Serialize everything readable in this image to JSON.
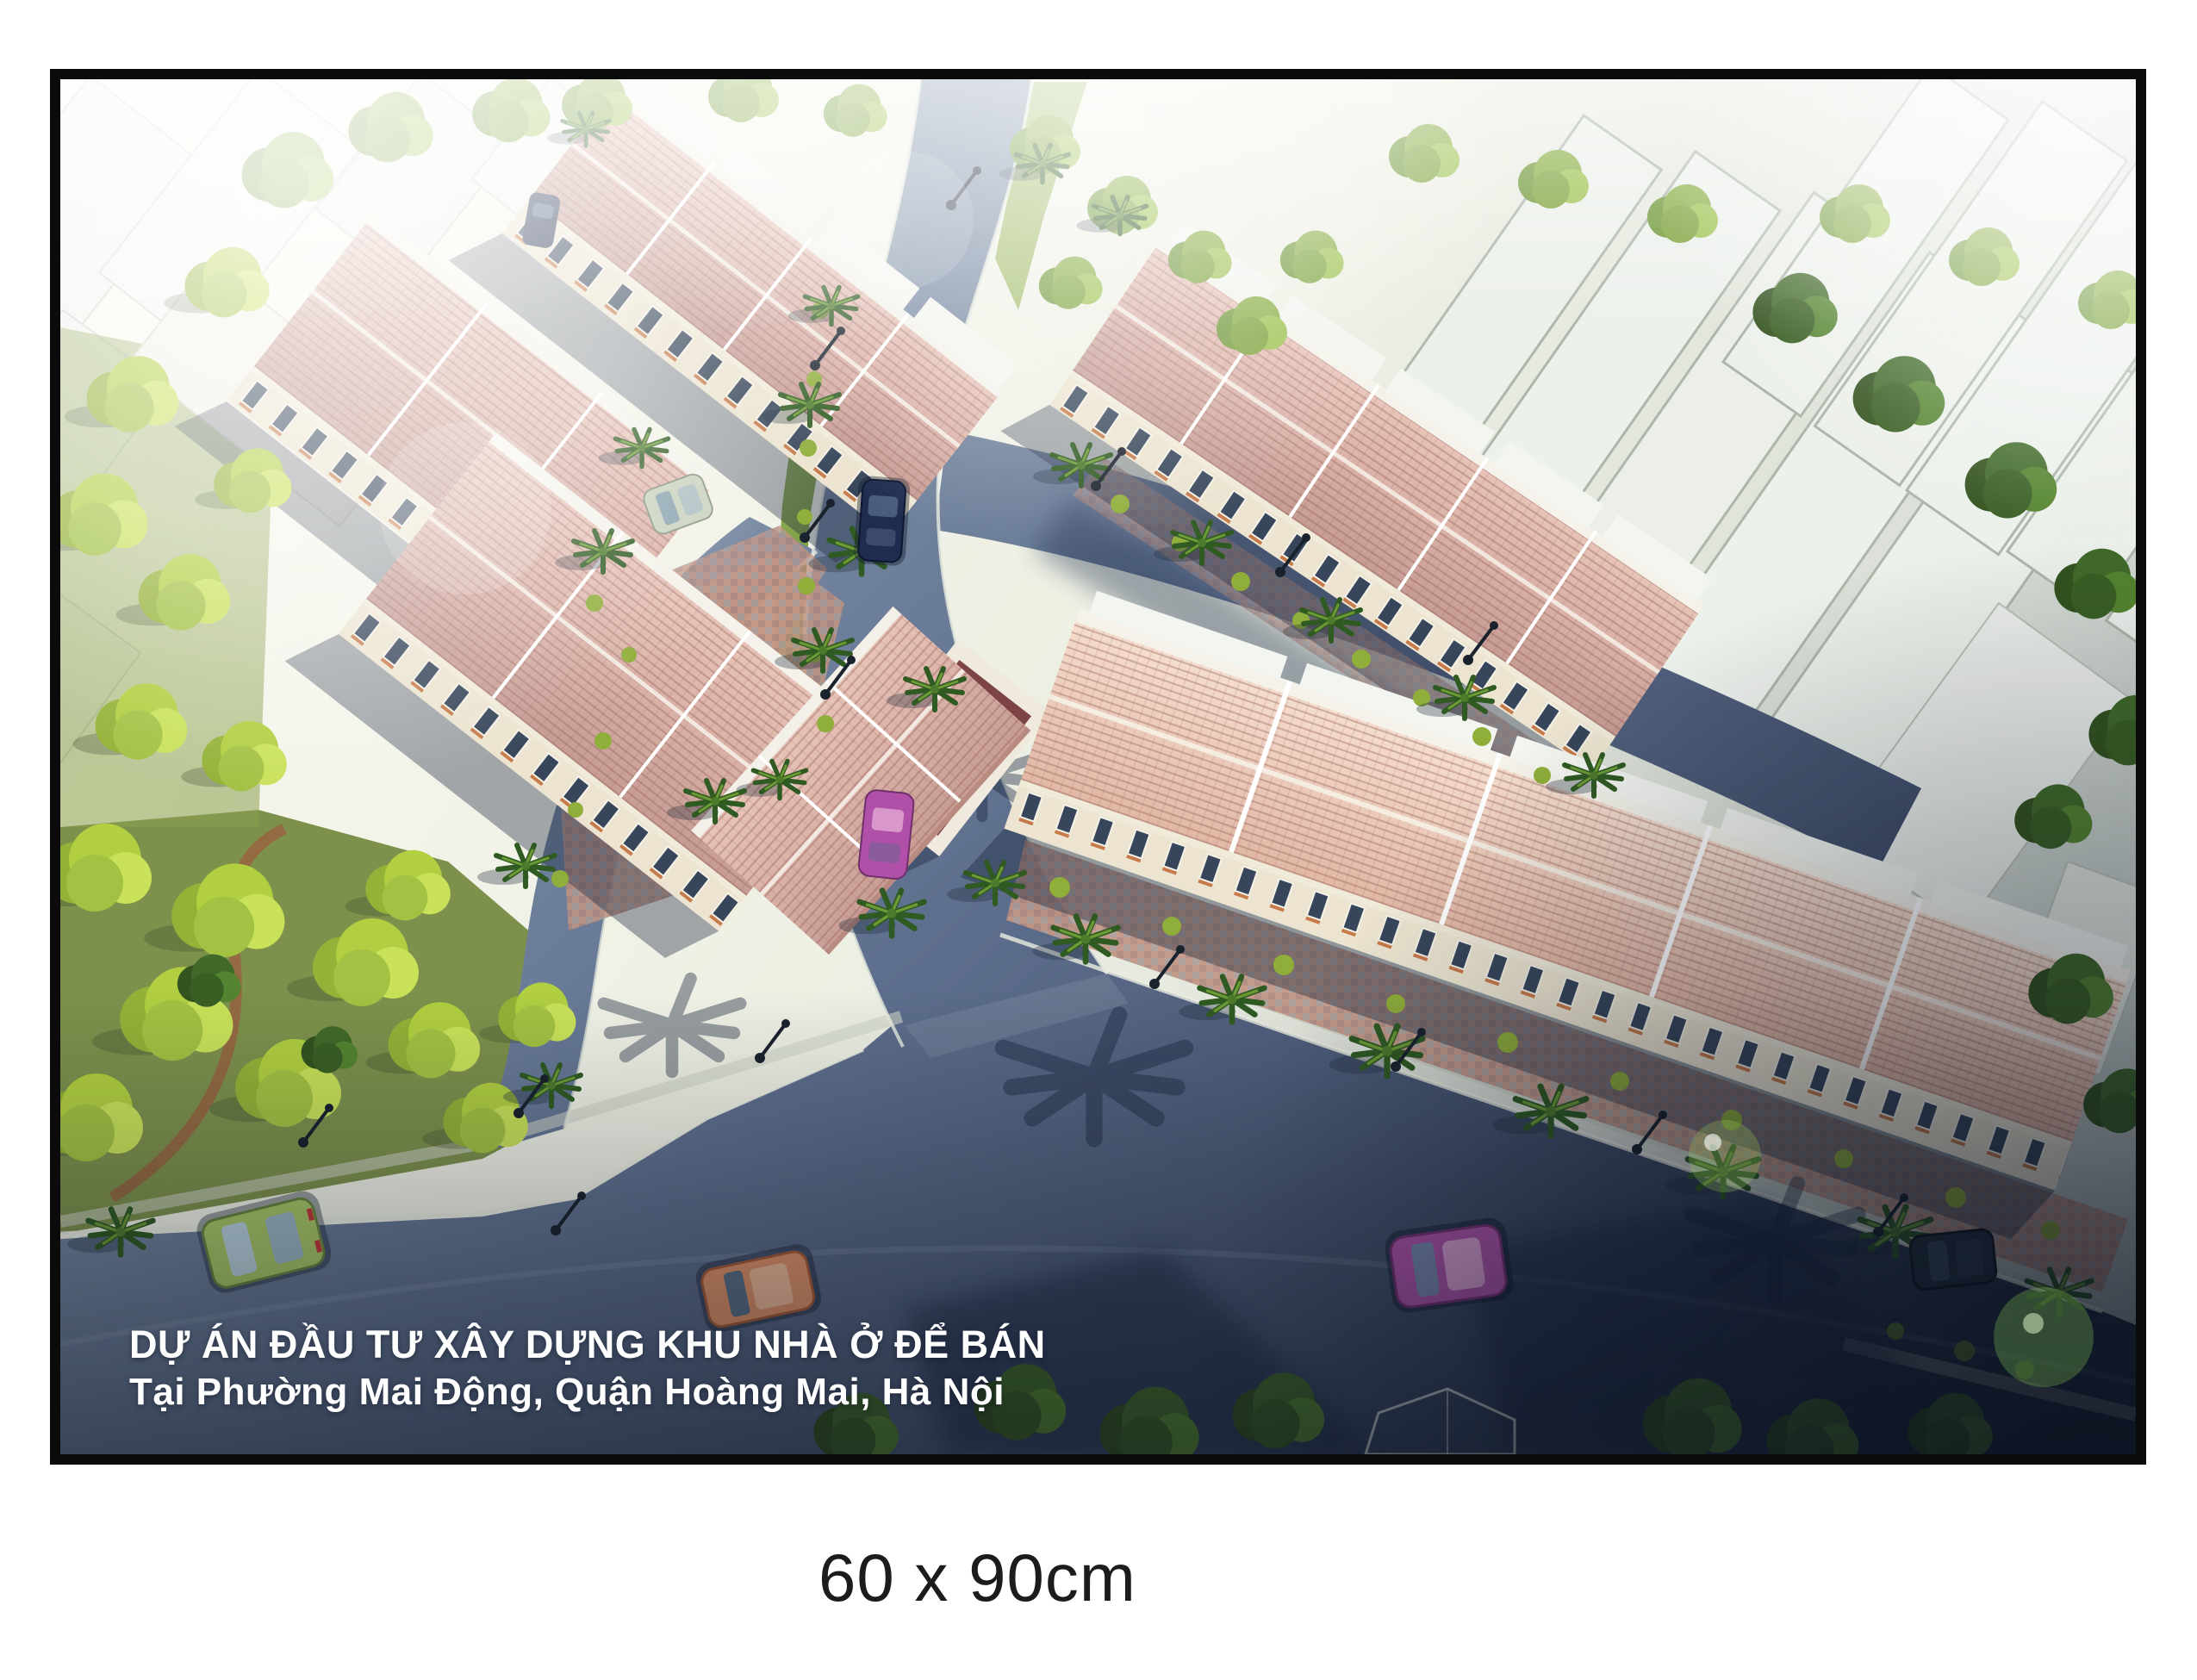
{
  "poster": {
    "overlay": {
      "title_line1": "DỰ ÁN ĐẦU TƯ XÂY DỰNG KHU NHÀ Ở ĐỂ BÁN",
      "title_line2": "Tại Phường Mai Động, Quận Hoàng Mai, Hà Nội"
    },
    "caption": {
      "size_label": "60 x 90cm"
    },
    "colors": {
      "page_background": "#ffffff",
      "frame": "#0b0b0b",
      "overlay_text": "#ffffff",
      "caption_text": "#1c1c1c",
      "roof_pink": "#d9b0a6",
      "roof_salmon": "#ecc8b4",
      "roof_flat_maroon": "#7c4444",
      "facade_cream": "#ece4d0",
      "window_dark": "#37465a",
      "tree_bright_green": "#b1cf40",
      "tree_dark_green": "#416a2a",
      "road_blue_gray": "#5d6e8c",
      "grass_green": "#7d914c",
      "paving_terracotta": "#c29483",
      "context_building_white": "#f1f3ee"
    }
  }
}
